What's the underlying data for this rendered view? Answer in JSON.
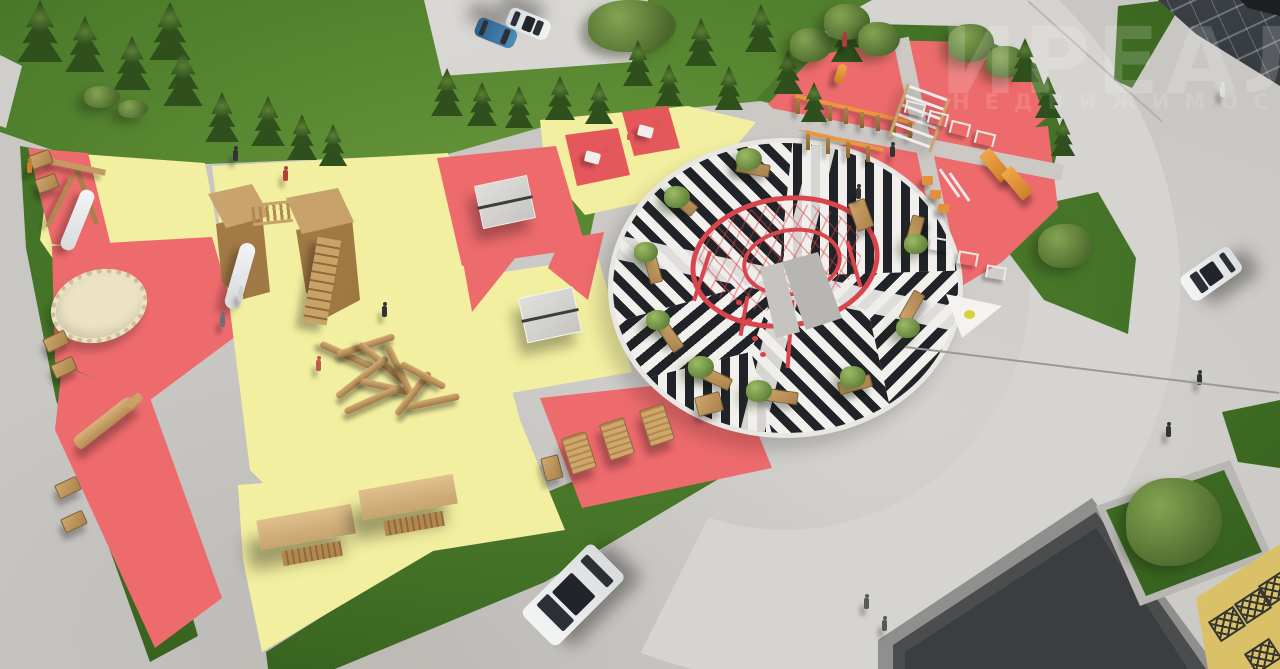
{
  "scene": {
    "description": "Aerial 3D architectural rendering of a residential courtyard playground and striped plaza",
    "watermark": {
      "line1": "ИРЕАЛ",
      "line2": "НЕДВИЖИМОСТЬ"
    }
  },
  "palette": {
    "pavement": "#c9c7c3",
    "road": "#d6d4d0",
    "grass": "#5d8a33",
    "zone_yellow": "#f3efa0",
    "zone_red": "#ee6b6d",
    "stripe_black": "#202327",
    "stripe_white": "#f1f0ec",
    "rope_red": "#d9454d",
    "wood": "#c49a62",
    "equipment_orange": "#e8973c",
    "building_dark": "#46484b",
    "truss_yellow": "#e9d47e",
    "car_blue": "#3d7cab",
    "car_white": "#eef0f1"
  },
  "zones": [
    {
      "name": "toddler-slide-zone-upper-left",
      "surface": "#f3efa0",
      "equipment": [
        "a-frame-slide",
        "benches"
      ]
    },
    {
      "name": "red-strip-zone-left",
      "surface": "#ee6b6d",
      "equipment": [
        "round-trampoline",
        "wooden-crocodile-sculpture",
        "benches"
      ]
    },
    {
      "name": "main-play-zone",
      "surface": "#f3efa0",
      "equipment": [
        "two-tower-playhouse-with-rope-bridge-and-slide",
        "log-climbing-pile"
      ]
    },
    {
      "name": "table-games-zone",
      "surface": "mixed red/yellow",
      "equipment": [
        "ping-pong-table",
        "ping-pong-table",
        "chess-table",
        "chess-table"
      ]
    },
    {
      "name": "lounger-deck-zone",
      "surface": "#ee6b6d",
      "equipment": [
        "wooden-loungers",
        "benches"
      ]
    },
    {
      "name": "swing-pergola-zone",
      "surface": "#f3efa0",
      "equipment": [
        "covered-swing",
        "covered-swing"
      ]
    },
    {
      "name": "striped-circular-plaza",
      "surface": "black-white-striped-paving",
      "equipment": [
        "red-rope-climbing-ring",
        "benches",
        "ornamental-trees"
      ]
    },
    {
      "name": "street-workout-zone",
      "surface": "#ee6b6d",
      "equipment": [
        "monkey-bars",
        "punching-bag",
        "ladder-wall",
        "hurdles",
        "incline-benches",
        "step-stools",
        "parallel-bars"
      ]
    }
  ],
  "vehicles": [
    {
      "name": "parked-car-blue",
      "color": "#3d7cab"
    },
    {
      "name": "parked-car-white",
      "color": "#eef0f1"
    },
    {
      "name": "driving-car-white-on-road",
      "color": "#eef0f1"
    },
    {
      "name": "driving-car-white-on-plaza",
      "color": "#eef0f1"
    }
  ],
  "buildings": [
    {
      "name": "glass-storefront-building-top-right"
    },
    {
      "name": "dark-flat-roof-building-bottom-right"
    },
    {
      "name": "yellow-truss-structure-bottom-right"
    }
  ],
  "people_count": 15
}
